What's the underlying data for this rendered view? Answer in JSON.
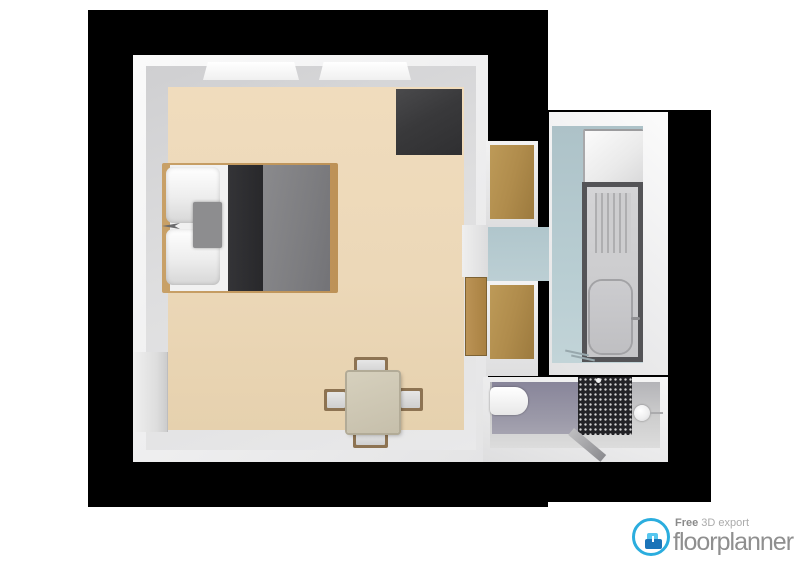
{
  "watermark": {
    "tagline_strong": "Free",
    "tagline_rest": " 3D export",
    "brand": "floorplanner",
    "ring_color": "#2badde",
    "glyph_dark_blue": "#1b74b8",
    "glyph_light_blue": "#56c6ef",
    "text_color": "#8f8f8f"
  },
  "plan": {
    "background_color": "#000000",
    "rooms": [
      {
        "name": "bedroom",
        "floor_color": "#ecd8b8",
        "wall_color": "#f0f0f0",
        "furniture": [
          "double-bed",
          "wardrobe",
          "dining-table",
          "chair-x4",
          "window-x2",
          "door-recess"
        ]
      },
      {
        "name": "hallway",
        "floor_color": "#b8cdd2",
        "furniture": [
          "closet-top",
          "closet-bottom",
          "wood-door-leaf"
        ]
      },
      {
        "name": "bathroom",
        "floor_color": "#b8cdd2",
        "furniture": [
          "cabinet",
          "bathtub-with-drainboard"
        ]
      },
      {
        "name": "toilet-room",
        "floor_color": "#9b99a8",
        "furniture": [
          "toilet",
          "round-sink",
          "perforated-shower-panel"
        ]
      }
    ],
    "furniture_colors": {
      "bed_duvet": "#7d7d80",
      "bed_fold": "#2b2b2e",
      "bed_frame_wood": "#c8a067",
      "wardrobe": "#39393b",
      "closet_wood": "#b08c4c",
      "tub_rim": "#545457"
    }
  }
}
